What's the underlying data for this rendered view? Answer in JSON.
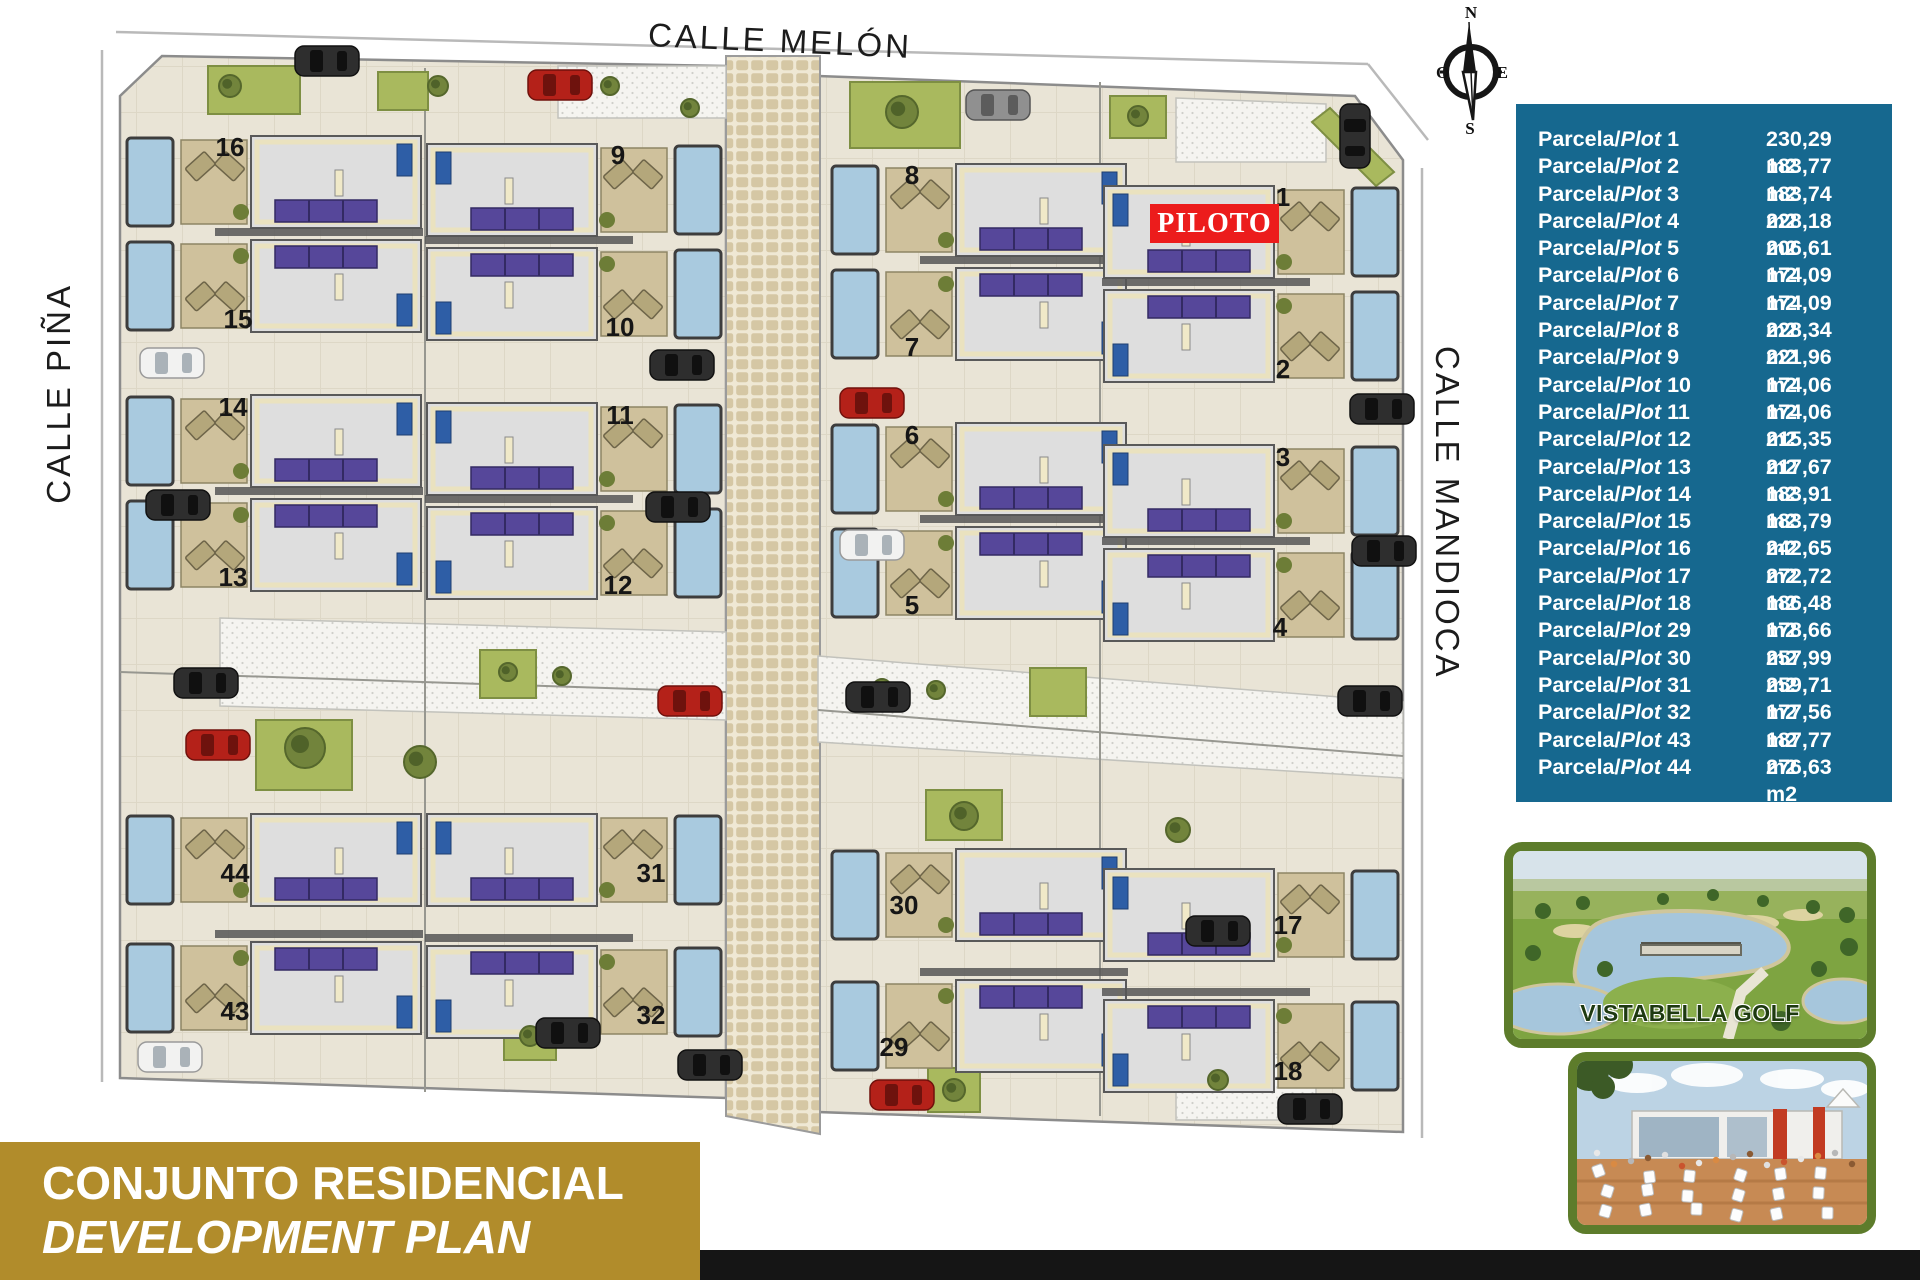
{
  "streets": {
    "top": "CALLE MELÓN",
    "left": "CALLE PIÑA",
    "right": "CALLE MANDIOCA"
  },
  "compass": {
    "n": "N",
    "s": "S",
    "e": "E",
    "w": "O"
  },
  "piloto": {
    "label": "PILOTO",
    "bg": "#ec1c1c"
  },
  "colors": {
    "table_bg": "#16688f",
    "banner_bg": "#b18c2b",
    "piloto_bg": "#ec1c1c",
    "photo_border": "#5d7c2b",
    "black_bar": "#151515",
    "ground": "#e9e4d6",
    "pool": "#a9cadf",
    "panels": "#56479a",
    "grass": "#a9b95e",
    "house": "#dedede",
    "terrace": "#cfc19c"
  },
  "map": {
    "plots": [
      {
        "no": "16",
        "x": 33,
        "y": 112,
        "dir": "e",
        "panels": "bottom",
        "nx": 140,
        "ny": 136
      },
      {
        "no": "15",
        "x": 33,
        "y": 216,
        "dir": "e",
        "panels": "top",
        "nx": 148,
        "ny": 308
      },
      {
        "no": "14",
        "x": 33,
        "y": 371,
        "dir": "e",
        "panels": "bottom",
        "nx": 143,
        "ny": 396
      },
      {
        "no": "13",
        "x": 33,
        "y": 475,
        "dir": "e",
        "panels": "top",
        "nx": 143,
        "ny": 566
      },
      {
        "no": "9",
        "x": 335,
        "y": 120,
        "dir": "w",
        "panels": "bottom",
        "nx": 528,
        "ny": 144
      },
      {
        "no": "10",
        "x": 335,
        "y": 224,
        "dir": "w",
        "panels": "top",
        "nx": 530,
        "ny": 316
      },
      {
        "no": "11",
        "x": 335,
        "y": 379,
        "dir": "w",
        "panels": "bottom",
        "nx": 530,
        "ny": 404
      },
      {
        "no": "12",
        "x": 335,
        "y": 483,
        "dir": "w",
        "panels": "top",
        "nx": 528,
        "ny": 574
      },
      {
        "no": "8",
        "x": 738,
        "y": 140,
        "dir": "e",
        "panels": "bottom",
        "nx": 822,
        "ny": 164
      },
      {
        "no": "7",
        "x": 738,
        "y": 244,
        "dir": "e",
        "panels": "top",
        "nx": 822,
        "ny": 336
      },
      {
        "no": "6",
        "x": 738,
        "y": 399,
        "dir": "e",
        "panels": "bottom",
        "nx": 822,
        "ny": 424
      },
      {
        "no": "5",
        "x": 738,
        "y": 503,
        "dir": "e",
        "panels": "top",
        "nx": 822,
        "ny": 594
      },
      {
        "no": "1",
        "x": 1012,
        "y": 162,
        "dir": "w",
        "panels": "bottom",
        "nx": 1193,
        "ny": 186
      },
      {
        "no": "2",
        "x": 1012,
        "y": 266,
        "dir": "w",
        "panels": "top",
        "nx": 1193,
        "ny": 358
      },
      {
        "no": "3",
        "x": 1012,
        "y": 421,
        "dir": "w",
        "panels": "bottom",
        "nx": 1193,
        "ny": 446
      },
      {
        "no": "4",
        "x": 1012,
        "y": 525,
        "dir": "w",
        "panels": "top",
        "nx": 1190,
        "ny": 616
      },
      {
        "no": "44",
        "x": 33,
        "y": 790,
        "dir": "e",
        "panels": "bottom",
        "nx": 145,
        "ny": 862
      },
      {
        "no": "43",
        "x": 33,
        "y": 918,
        "dir": "e",
        "panels": "top",
        "nx": 145,
        "ny": 1000
      },
      {
        "no": "31",
        "x": 335,
        "y": 790,
        "dir": "w",
        "panels": "bottom",
        "nx": 561,
        "ny": 862
      },
      {
        "no": "32",
        "x": 335,
        "y": 922,
        "dir": "w",
        "panels": "top",
        "nx": 561,
        "ny": 1004
      },
      {
        "no": "30",
        "x": 738,
        "y": 825,
        "dir": "e",
        "panels": "bottom",
        "nx": 814,
        "ny": 894
      },
      {
        "no": "29",
        "x": 738,
        "y": 956,
        "dir": "e",
        "panels": "top",
        "nx": 804,
        "ny": 1036
      },
      {
        "no": "17",
        "x": 1012,
        "y": 845,
        "dir": "w",
        "panels": "bottom",
        "nx": 1198,
        "ny": 914
      },
      {
        "no": "18",
        "x": 1012,
        "y": 976,
        "dir": "w",
        "panels": "top",
        "nx": 1198,
        "ny": 1060
      }
    ],
    "cars": [
      {
        "x": 205,
        "y": 26,
        "c": "dark"
      },
      {
        "x": 438,
        "y": 50,
        "c": "red"
      },
      {
        "x": 876,
        "y": 70,
        "c": "gray"
      },
      {
        "x": 1280,
        "y": 84,
        "c": "dark",
        "v": true
      },
      {
        "x": 50,
        "y": 328,
        "c": "white"
      },
      {
        "x": 56,
        "y": 470,
        "c": "dark"
      },
      {
        "x": 84,
        "y": 648,
        "c": "dark"
      },
      {
        "x": 96,
        "y": 710,
        "c": "red"
      },
      {
        "x": 560,
        "y": 330,
        "c": "dark"
      },
      {
        "x": 556,
        "y": 472,
        "c": "dark"
      },
      {
        "x": 568,
        "y": 666,
        "c": "red"
      },
      {
        "x": 750,
        "y": 368,
        "c": "red"
      },
      {
        "x": 750,
        "y": 510,
        "c": "white"
      },
      {
        "x": 756,
        "y": 662,
        "c": "dark"
      },
      {
        "x": 1260,
        "y": 374,
        "c": "dark"
      },
      {
        "x": 1262,
        "y": 516,
        "c": "dark"
      },
      {
        "x": 1248,
        "y": 666,
        "c": "dark"
      },
      {
        "x": 48,
        "y": 1022,
        "c": "white"
      },
      {
        "x": 446,
        "y": 998,
        "c": "dark"
      },
      {
        "x": 588,
        "y": 1030,
        "c": "dark"
      },
      {
        "x": 780,
        "y": 1060,
        "c": "red"
      },
      {
        "x": 1096,
        "y": 896,
        "c": "dark"
      },
      {
        "x": 1188,
        "y": 1074,
        "c": "dark"
      }
    ],
    "trees": [
      {
        "x": 140,
        "y": 66,
        "r": 11
      },
      {
        "x": 348,
        "y": 66,
        "r": 10
      },
      {
        "x": 520,
        "y": 66,
        "r": 9
      },
      {
        "x": 600,
        "y": 88,
        "r": 9
      },
      {
        "x": 812,
        "y": 92,
        "r": 16
      },
      {
        "x": 1048,
        "y": 96,
        "r": 10
      },
      {
        "x": 418,
        "y": 652,
        "r": 9
      },
      {
        "x": 472,
        "y": 656,
        "r": 9
      },
      {
        "x": 792,
        "y": 668,
        "r": 9
      },
      {
        "x": 846,
        "y": 670,
        "r": 9
      },
      {
        "x": 215,
        "y": 728,
        "r": 20
      },
      {
        "x": 330,
        "y": 742,
        "r": 16
      },
      {
        "x": 874,
        "y": 796,
        "r": 14
      },
      {
        "x": 1088,
        "y": 810,
        "r": 12
      },
      {
        "x": 440,
        "y": 1016,
        "r": 10
      },
      {
        "x": 864,
        "y": 1070,
        "r": 11
      },
      {
        "x": 1128,
        "y": 1060,
        "r": 10
      }
    ],
    "grass": [
      {
        "x": 118,
        "y": 46,
        "w": 92,
        "h": 48
      },
      {
        "x": 288,
        "y": 52,
        "w": 50,
        "h": 38
      },
      {
        "x": 760,
        "y": 62,
        "w": 110,
        "h": 66
      },
      {
        "x": 1020,
        "y": 76,
        "w": 56,
        "h": 42
      },
      {
        "x": 390,
        "y": 630,
        "w": 56,
        "h": 48
      },
      {
        "x": 940,
        "y": 648,
        "w": 56,
        "h": 48
      },
      {
        "x": 166,
        "y": 700,
        "w": 96,
        "h": 70
      },
      {
        "x": 836,
        "y": 770,
        "w": 76,
        "h": 50
      },
      {
        "x": 414,
        "y": 996,
        "w": 52,
        "h": 44
      },
      {
        "x": 838,
        "y": 1048,
        "w": 52,
        "h": 44
      }
    ]
  },
  "table": {
    "label_prefix": "Parcela/",
    "label_word": "Plot",
    "unit": "m2",
    "rows": [
      {
        "plot": "1",
        "area": "230,29"
      },
      {
        "plot": "2",
        "area": "183,77"
      },
      {
        "plot": "3",
        "area": "183,74"
      },
      {
        "plot": "4",
        "area": "228,18"
      },
      {
        "plot": "5",
        "area": "206,61"
      },
      {
        "plot": "6",
        "area": "174,09"
      },
      {
        "plot": "7",
        "area": "174,09"
      },
      {
        "plot": "8",
        "area": "228,34"
      },
      {
        "plot": "9",
        "area": "221,96"
      },
      {
        "plot": "10",
        "area": "174,06"
      },
      {
        "plot": "11",
        "area": "174,06"
      },
      {
        "plot": "12",
        "area": "215,35"
      },
      {
        "plot": "13",
        "area": "217,67"
      },
      {
        "plot": "14",
        "area": "183,91"
      },
      {
        "plot": "15",
        "area": "183,79"
      },
      {
        "plot": "16",
        "area": "242,65"
      },
      {
        "plot": "17",
        "area": "272,72"
      },
      {
        "plot": "18",
        "area": "186,48"
      },
      {
        "plot": "29",
        "area": "178,66"
      },
      {
        "plot": "30",
        "area": "257,99"
      },
      {
        "plot": "31",
        "area": "259,71"
      },
      {
        "plot": "32",
        "area": "177,56"
      },
      {
        "plot": "43",
        "area": "187,77"
      },
      {
        "plot": "44",
        "area": "276,63"
      }
    ]
  },
  "golf": {
    "caption": "VISTABELLA GOLF"
  },
  "banner": {
    "line1": "CONJUNTO RESIDENCIAL",
    "line2": "DEVELOPMENT PLAN",
    "bg": "#b18c2b"
  }
}
